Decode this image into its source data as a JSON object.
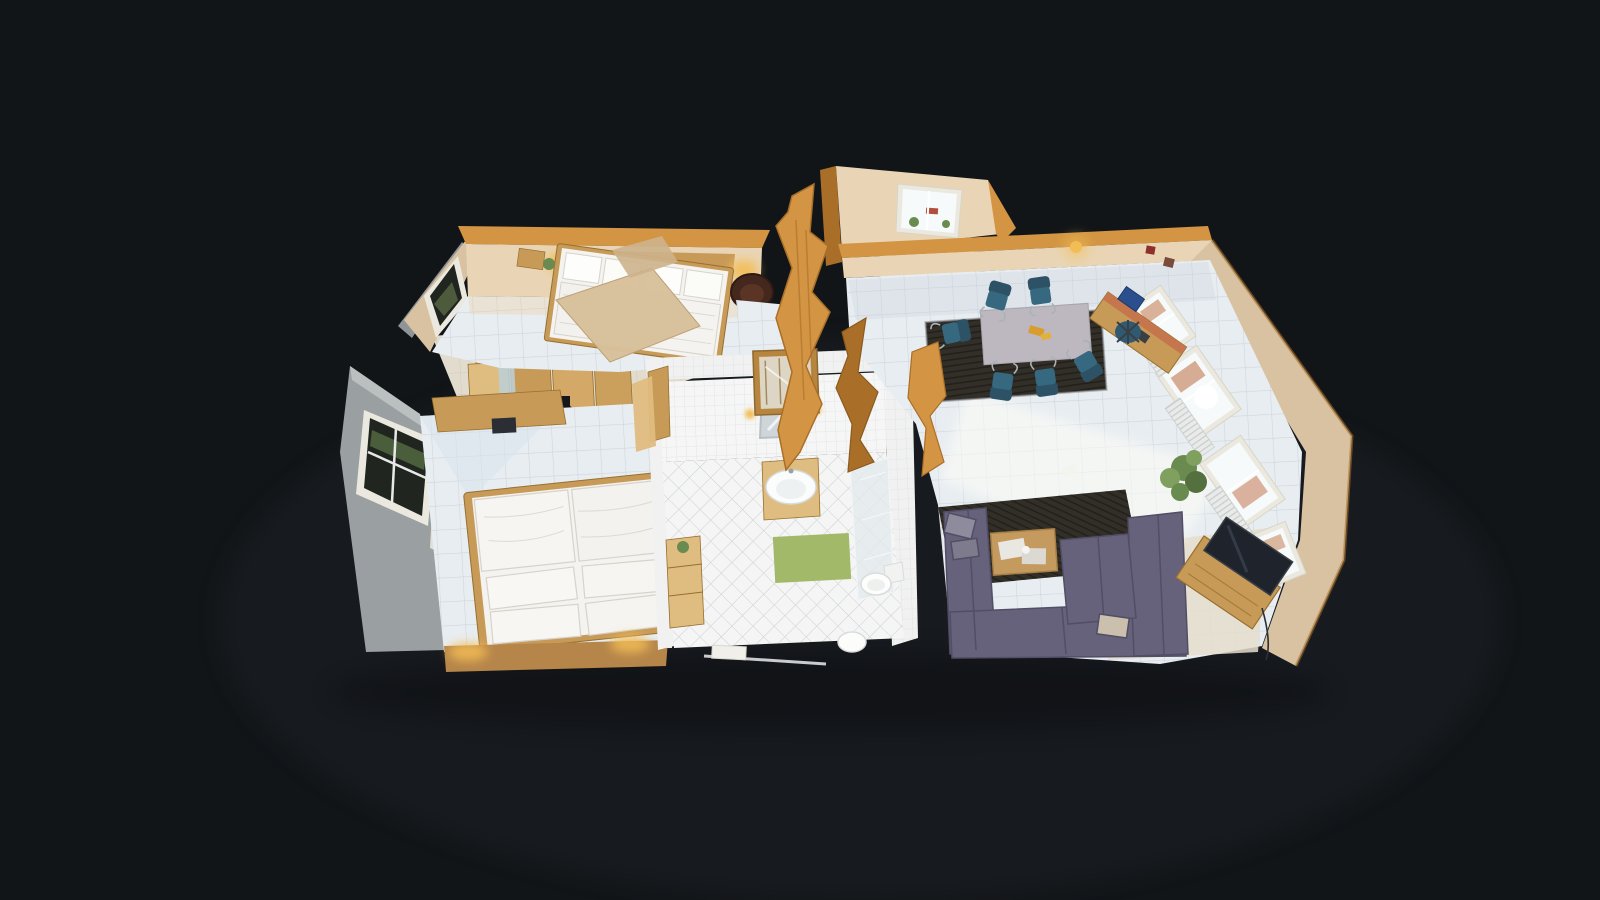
{
  "app": {
    "name": "3d-tour-dollhouse-viewer",
    "view_mode": "dollhouse",
    "visible_text": "none"
  },
  "scene": {
    "type": "residential-apartment-3d-scan",
    "camera": "top-down oblique dollhouse cutaway",
    "rooms": [
      {
        "id": "master-bedroom",
        "position": "top-left",
        "contents": [
          "double-bed-white-bedding",
          "headboard-lamps",
          "nightstand",
          "dark-brown-barrel-armchair",
          "window-dark-frame",
          "sloped-ceiling-cut-fragment"
        ]
      },
      {
        "id": "hallway",
        "position": "center-left",
        "contents": [
          "pine-wardrobes",
          "mirror-strip",
          "camera-tripod",
          "sideboard",
          "dark-tv-object"
        ]
      },
      {
        "id": "second-bedroom",
        "position": "bottom-left",
        "contents": [
          "double-bed-two-duvets-four-pillows",
          "wardrobe-cabinets",
          "window-in-gray-wall",
          "curtain",
          "warm-bedside-lamps",
          "white-tile-floor"
        ]
      },
      {
        "id": "bathroom",
        "position": "center",
        "contents": [
          "vanity-sink-wood-cabinet",
          "mirror-with-sconces",
          "glass-shower",
          "toilet",
          "second-toilet-fixture",
          "green-bath-mat",
          "wood-shelf",
          "towel-rail",
          "display-cabinet",
          "diamond-tile-floor"
        ]
      },
      {
        "id": "dormer-nook",
        "position": "top-center",
        "contents": [
          "dormer-window-with-plants",
          "radiator"
        ]
      },
      {
        "id": "living-dining-room",
        "position": "right",
        "contents": [
          "dining-table-gray-cloth",
          "teal-cantilever-chairs-x6",
          "dark-striped-dining-rug",
          "desk-terracotta-top",
          "blue-office-chair",
          "windows-x3-with-radiators",
          "potted-plant",
          "purple-sectional-sofa",
          "coffee-table-with-newspapers",
          "dark-sofa-rug",
          "tv-on-wood-stand",
          "pendant-lamp",
          "small-red-wall-pictures",
          "sunlight-patch-on-tiles"
        ]
      }
    ],
    "palette": {
      "bg": "#121518",
      "glow": "#262c31",
      "shadow": "#000000",
      "wallCut": "#d39543",
      "wallCutDark": "#a96f28",
      "wallBeige": "#d8c2a2",
      "wallBeigeLit": "#e9d5b5",
      "wallGray": "#9aa0a2",
      "wood": "#c89a58",
      "woodLight": "#dfbc80",
      "woodDark": "#96702f",
      "tileWhite": "#e8edf1",
      "tileWarm": "#e5ddcc",
      "bathWall": "#f0f1f0",
      "bathFloor": "#f4f5f4",
      "bedWhite": "#f4f3ef",
      "bedShadow": "#d7d3cb",
      "rugDark": "#322e28",
      "sofa": "#66627b",
      "sofaDark": "#514e66",
      "chairTeal": "#36687f",
      "tableCloth": "#bdb8bf",
      "armchair": "#44281d",
      "matGreen": "#a3b96a",
      "plant": "#6a8b4f",
      "tv": "#1f232b",
      "radiator": "#e9ebea",
      "windowFrame": "#ebe9df",
      "glass": "#f7fafb",
      "glowWarm": "#f3bd55",
      "sun": "#fcfcf7",
      "curtain": "#e9e5da",
      "darkGlass": "#20261f"
    }
  }
}
